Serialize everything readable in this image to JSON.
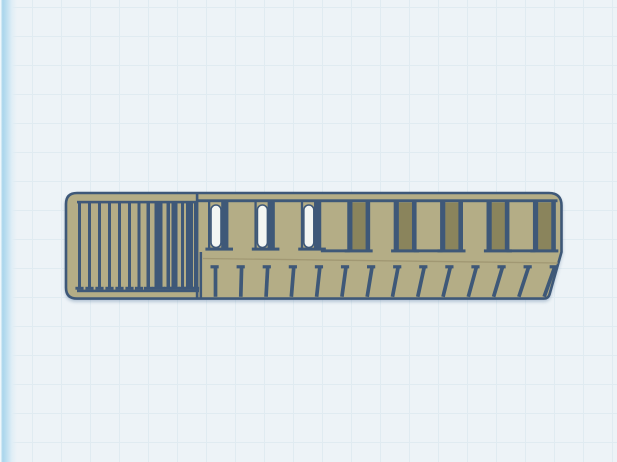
{
  "canvas": {
    "grid_size_px": 29
  },
  "colors": {
    "background": "#edf3f7",
    "grid_line": "#e0ebf1",
    "edge_glow": "#a9d5ec",
    "body": "#b4ad86",
    "outline": "#3e5878",
    "through_hole": "#f3f6f3",
    "blind_hole": "#8a845c",
    "shade_line": "#9e9671"
  },
  "model": {
    "name": "khaki-slotted-comb-part",
    "grille": {
      "stripes": [
        {
          "x": 78,
          "w": 3
        },
        {
          "x": 88,
          "w": 3
        },
        {
          "x": 98,
          "w": 3
        },
        {
          "x": 108,
          "w": 3
        },
        {
          "x": 118,
          "w": 3
        },
        {
          "x": 128,
          "w": 3
        },
        {
          "x": 137.5,
          "w": 3
        },
        {
          "x": 146.5,
          "w": 3.5
        },
        {
          "x": 154.5,
          "w": 8
        },
        {
          "x": 166.5,
          "w": 3.5
        },
        {
          "x": 171.5,
          "w": 6
        },
        {
          "x": 181,
          "w": 3
        },
        {
          "x": 186,
          "w": 7
        },
        {
          "x": 194,
          "w": 2.5
        }
      ]
    },
    "slots": [
      "through",
      "through",
      "through",
      "blind",
      "blind",
      "blind",
      "blind",
      "blind"
    ],
    "teeth_count": 14
  }
}
